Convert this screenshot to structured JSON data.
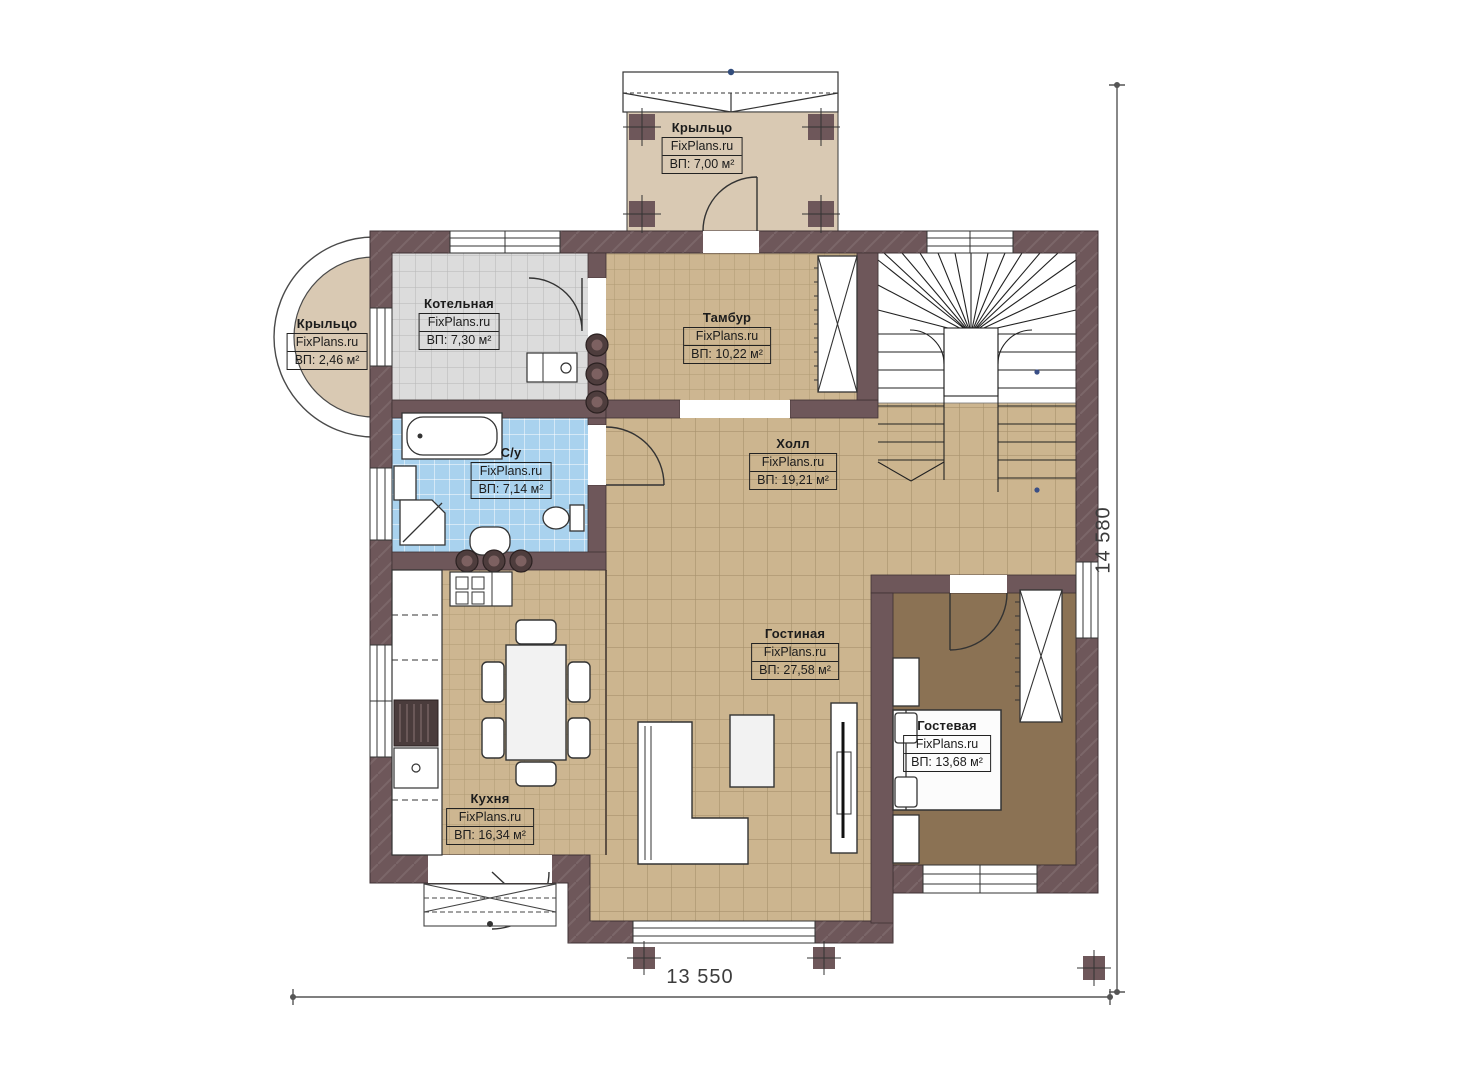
{
  "site": "FixPlans.ru",
  "plan": {
    "dimensions": {
      "width": "13 550",
      "height": "14 580"
    }
  },
  "rooms": [
    {
      "id": "porch-top",
      "name": "Крыльцо",
      "area": "ВП: 7,00 м²"
    },
    {
      "id": "porch-left",
      "name": "Крыльцо",
      "area": "ВП: 2,46 м²"
    },
    {
      "id": "boiler",
      "name": "Котельная",
      "area": "ВП: 7,30 м²"
    },
    {
      "id": "vestibule",
      "name": "Тамбур",
      "area": "ВП: 10,22 м²"
    },
    {
      "id": "bathroom",
      "name": "С/у",
      "area": "ВП: 7,14 м²"
    },
    {
      "id": "hall",
      "name": "Холл",
      "area": "ВП: 19,21 м²"
    },
    {
      "id": "kitchen",
      "name": "Кухня",
      "area": "ВП: 16,34 м²"
    },
    {
      "id": "living",
      "name": "Гостиная",
      "area": "ВП: 27,58 м²"
    },
    {
      "id": "guest",
      "name": "Гостевая",
      "area": "ВП: 13,68 м²"
    }
  ],
  "colors": {
    "wall": "#6e575a",
    "floor_tile_tan": "#cdb691",
    "floor_tile_gray": "#dcdcdc",
    "floor_tile_blue": "#a9d2ee",
    "floor_carpet_brown": "#8b7254",
    "porch_slab": "#d9c9b3"
  }
}
